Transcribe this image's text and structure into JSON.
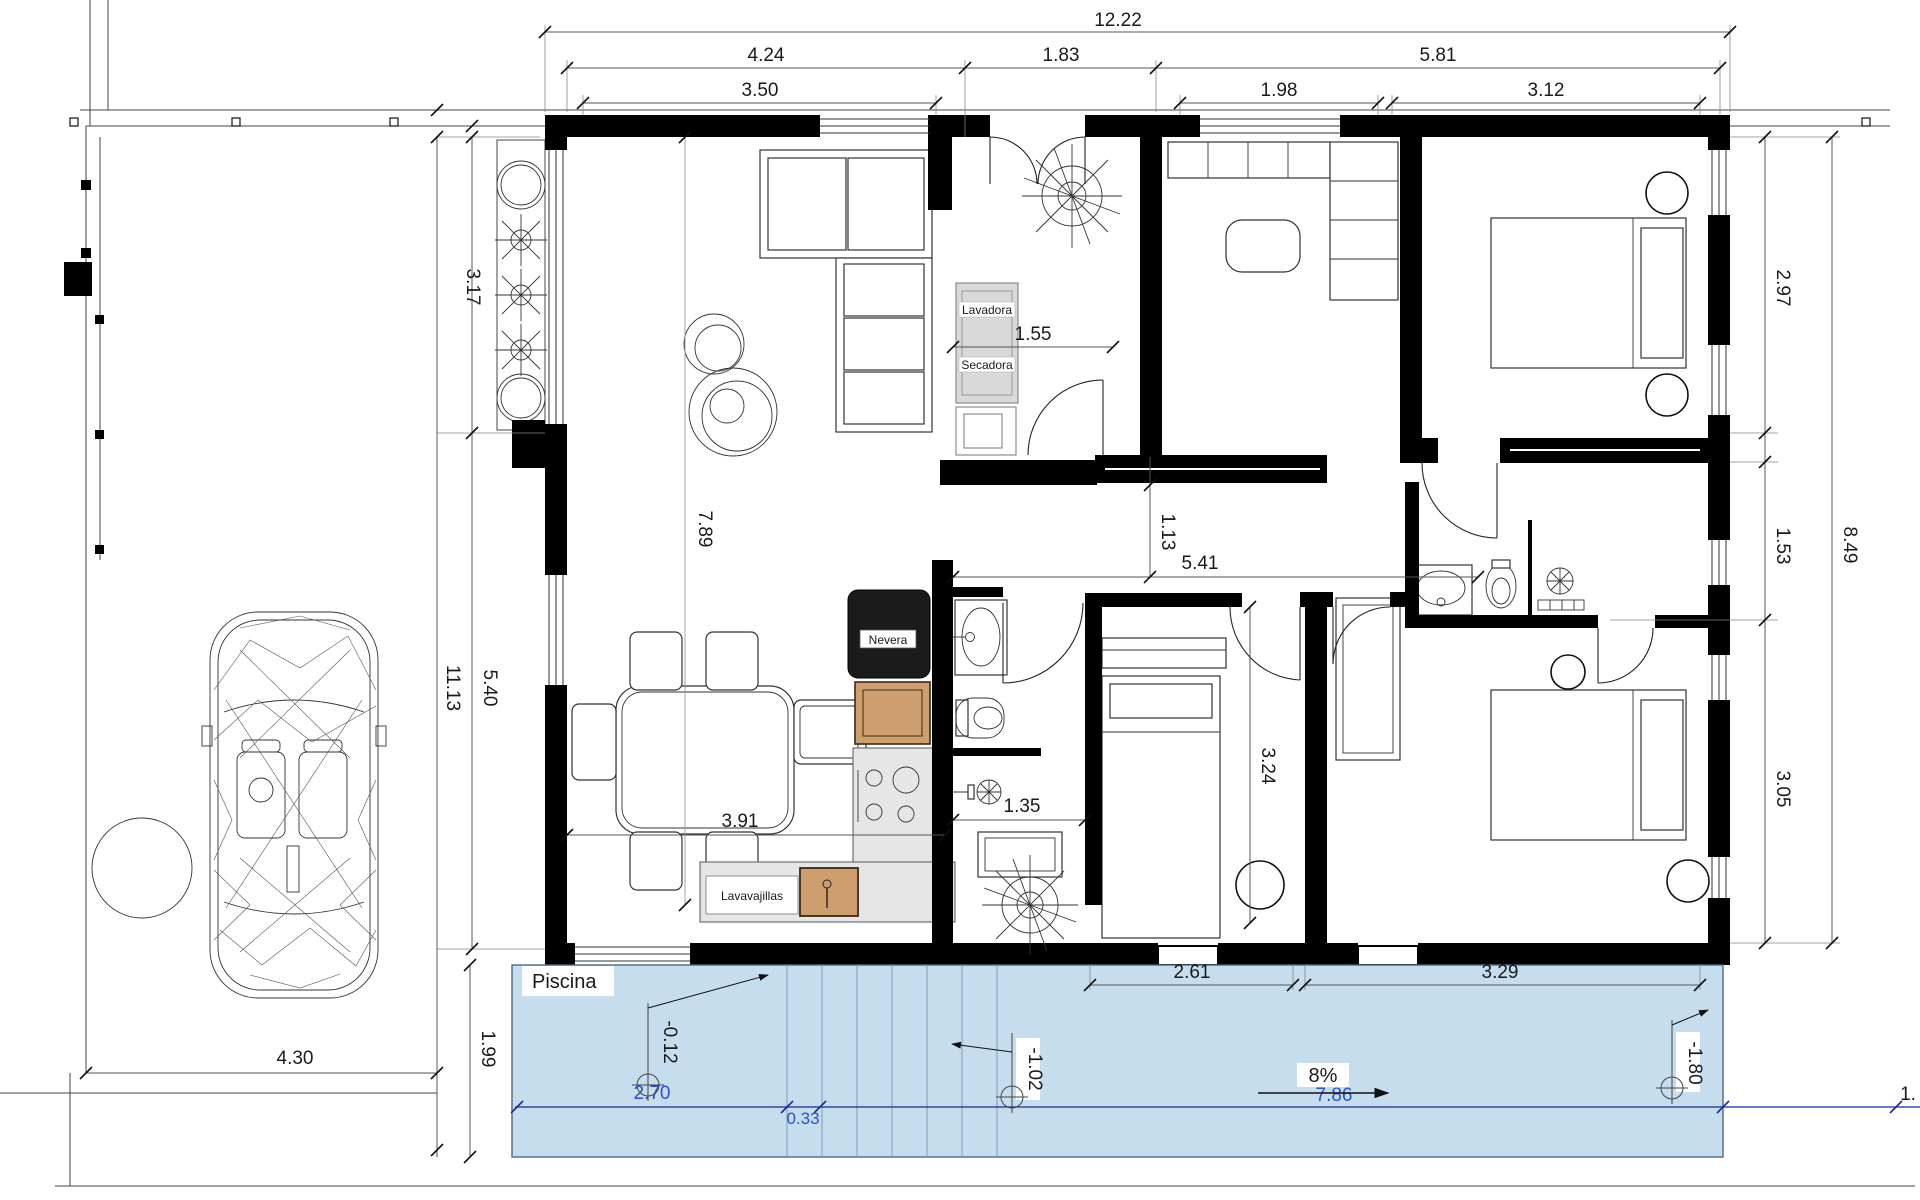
{
  "drawing": {
    "pool": {
      "label": "Piscina",
      "dim_a": "2.70",
      "dim_step": "0.33",
      "dim_b": "7.86",
      "slope": "8%",
      "elev_shallow": "-0.12",
      "elev_mid": "-1.02",
      "elev_deep": "-1.80",
      "edge_partial": "1."
    },
    "appliances": {
      "washer": "Lavadora",
      "dryer": "Secadora",
      "fridge": "Nevera",
      "dishwasher": "Lavavajillas"
    },
    "dims": {
      "top_total": "12.22",
      "top_left": "4.24",
      "top_mid": "1.83",
      "top_right": "5.81",
      "top_left_win": "3.50",
      "top_mid_win": "1.98",
      "top_right_win": "3.12",
      "left_upper": "3.17",
      "left_mid": "5.40",
      "left_total": "11.13",
      "right_upper": "2.97",
      "right_mid": "1.53",
      "right_lower": "3.05",
      "right_total": "8.49",
      "laundry_w": "1.55",
      "living_v": "7.89",
      "hall_v": "1.13",
      "hall_h": "5.41",
      "bedroom_v": "3.24",
      "kitchen_w": "3.91",
      "bath_w": "1.35",
      "bottom_left_win": "2.61",
      "bottom_right_win": "3.29",
      "drive_w": "4.30",
      "deck_d": "1.99"
    },
    "colors": {
      "pool_fill": "#c6dded",
      "pool_dim_text": "#3050c8",
      "pool_dim_line": "#1b2a96",
      "wall": "#000000",
      "cabinet_brown": "#cf9e6e",
      "appliance_gray": "#d9d9d9"
    }
  }
}
